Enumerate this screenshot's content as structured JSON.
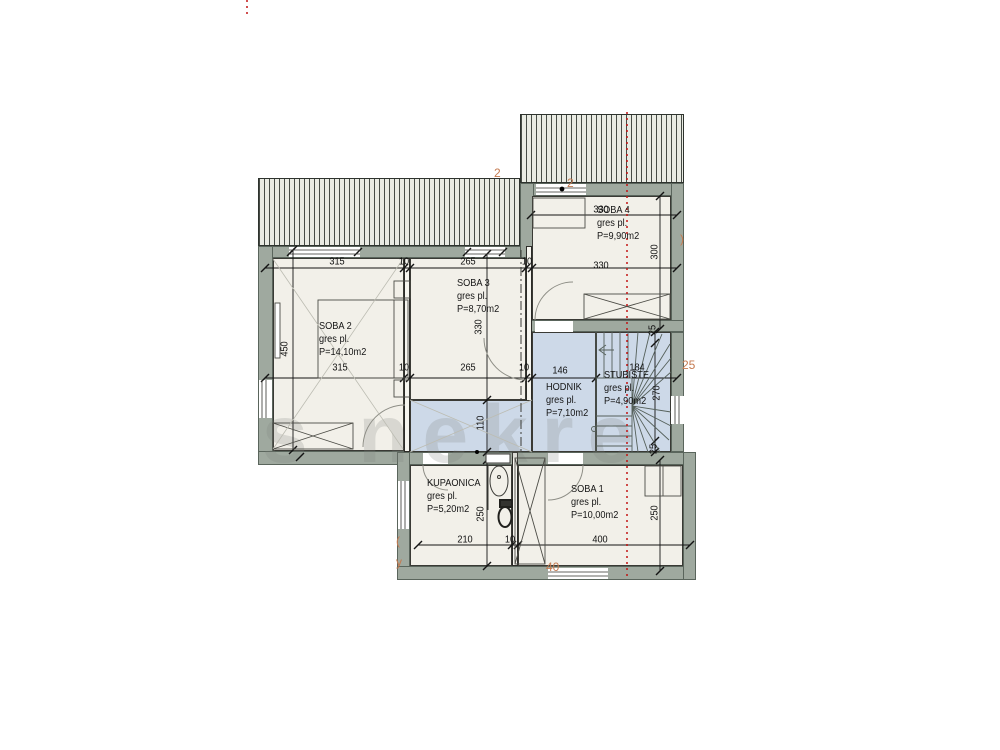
{
  "watermark": "s nekre",
  "rooms": [
    {
      "name": "SOBA 2",
      "finish": "gres pl.",
      "area": "P=14,10m2"
    },
    {
      "name": "SOBA 3",
      "finish": "gres pl.",
      "area": "P=8,70m2"
    },
    {
      "name": "SOBA 4",
      "finish": "gres pl.",
      "area": "P=9,90m2"
    },
    {
      "name": "HODNIK",
      "finish": "gres pl.",
      "area": "P=7,10m2"
    },
    {
      "name": "STUBIŠTE",
      "finish": "gres pl.",
      "area": "P=4,90m2"
    },
    {
      "name": "KUPAONICA",
      "finish": "gres pl.",
      "area": "P=5,20m2"
    },
    {
      "name": "SOBA 1",
      "finish": "gres pl.",
      "area": "P=10,00m2"
    }
  ],
  "dims": [
    "315",
    "10",
    "265",
    "10",
    "330",
    "330",
    "300",
    "315",
    "10",
    "265",
    "10",
    "146",
    "184",
    "450",
    "330",
    "110",
    "25",
    "270",
    "25",
    "250",
    "250",
    "210",
    "10",
    "400"
  ],
  "remnants": [
    {
      "t": "2"
    },
    {
      "t": "2"
    },
    {
      "t": ")"
    },
    {
      "t": "25"
    },
    {
      "t": "40"
    },
    {
      "t": "("
    },
    {
      "t": "y"
    }
  ],
  "colors": {
    "wall": "#9fa99f",
    "floor": "#f2f0e9",
    "zone": "#cdd9e8",
    "hatch": "#e9ebe3",
    "section_line": "#c11414",
    "remnant_text": "#c57a50"
  }
}
